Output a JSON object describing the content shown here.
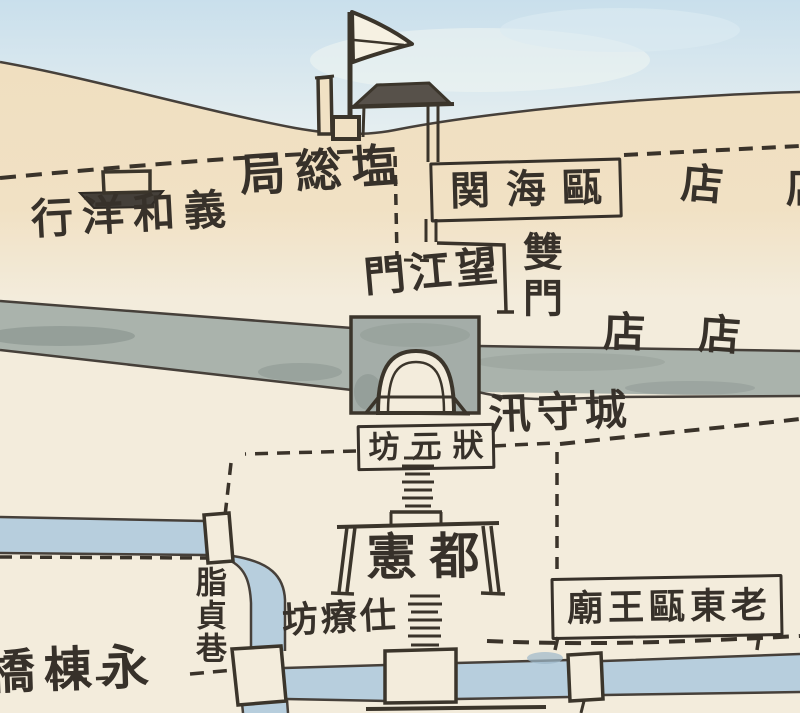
{
  "map": {
    "type": "hand-drawn historical city map (watercolor scan)",
    "labels": {
      "salt_bureau": "局総塩",
      "customs": "関海甌",
      "yihe_yanghang": "行洋和義",
      "shop_hill": "店",
      "shop_hill_right_partial": "店",
      "wangjiang_gate": "門江望",
      "shuang_men": "雙門",
      "shop_street_left": "店",
      "shop_street_right": "店",
      "chengshou_xun": "汛守城",
      "zhuangyuan_fang": "坊元狀",
      "du_xian": "憲都",
      "zhizhen_xiang": "脂貞巷",
      "shiliao_fang": "坊療仕",
      "lao_dongou_wang_miao": "廟王甌東老",
      "yongdong_qiao": "橋棟永"
    },
    "features": [
      "pennant-flag-on-pole",
      "hip-roof-customs-house",
      "chimney-pole",
      "small-boat",
      "gray-city-wall-band",
      "arched-city-gate",
      "memorial-archway",
      "stepped-ladder-paths",
      "dashed-roads",
      "blue-canals",
      "four-bridges"
    ],
    "colors": {
      "paper": "#f3ecdc",
      "hill_tan": "#f1e1c4",
      "sky_blue": "#cfe3ee",
      "ink": "#3b352b",
      "wall_gray": "#aab3ac",
      "water_blue": "#b7cedd"
    }
  }
}
